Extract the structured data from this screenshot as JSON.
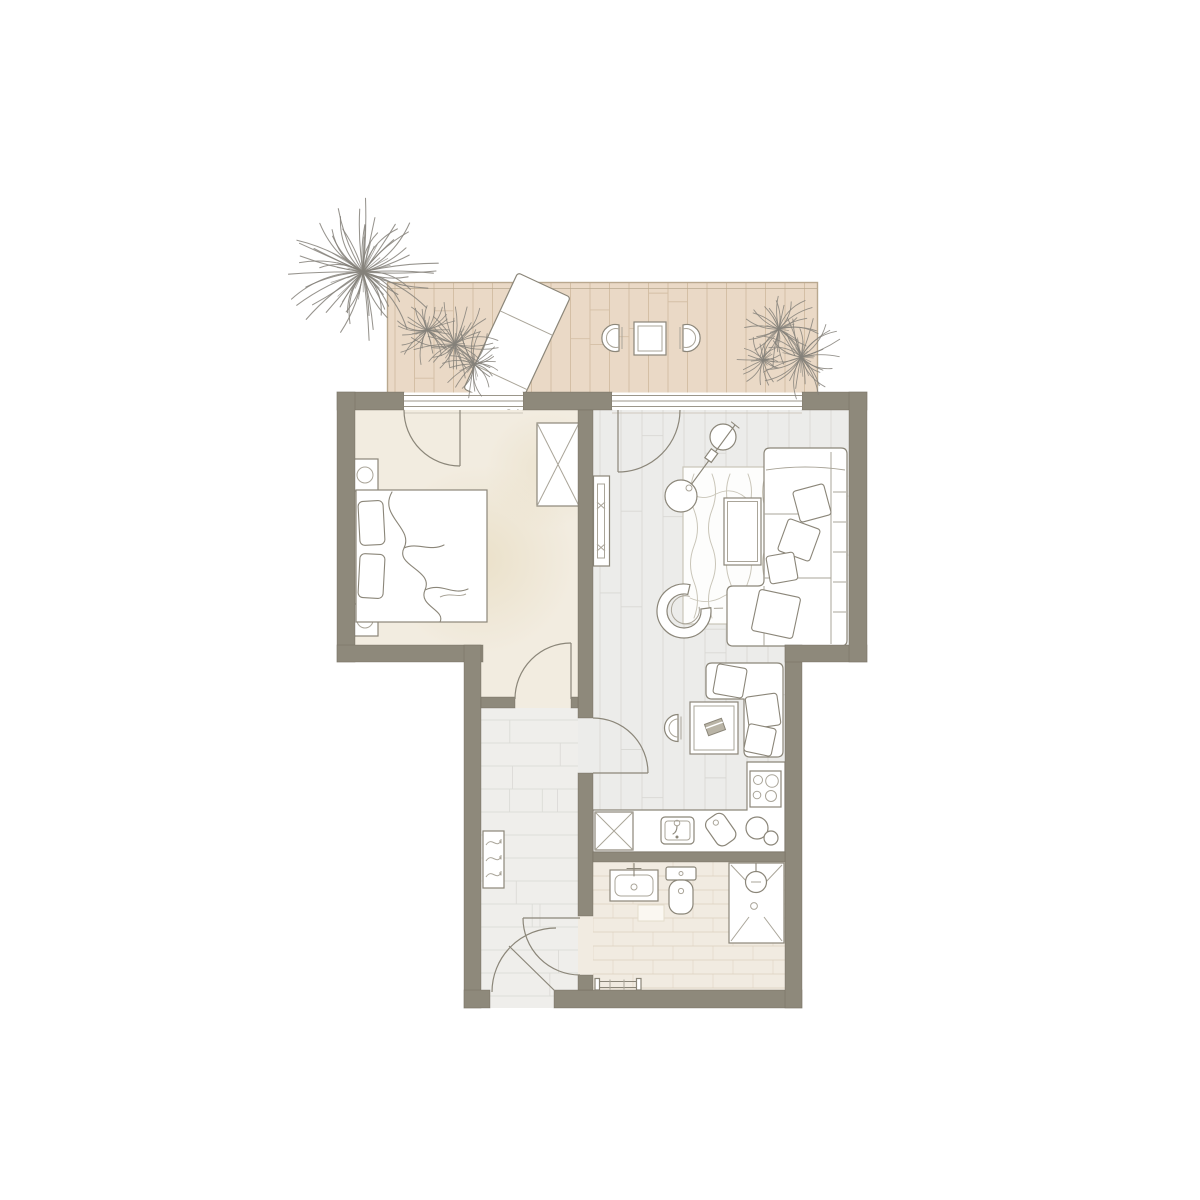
{
  "colors": {
    "wall": "#8e897b",
    "wall-edge": "#6f6a5c",
    "deck": "#ead9c6",
    "deck-line": "#d4bfa5",
    "deck-edge": "#b9a88f",
    "bedroom-floor": "#f2ece0",
    "bedroom-mottle": "#e2d3ae",
    "wood-floor": "#ececea",
    "wood-line": "#d8d7d3",
    "hall-floor": "#efeeeb",
    "hall-line": "#dcdbd7",
    "bath-floor": "#f1ebe1",
    "bath-line": "#ddd2c1",
    "ink": "#8b8679",
    "ink-light": "#aaa599",
    "rug-line": "#c9c5b8",
    "plant": "#85817a",
    "glass": "#9b968a",
    "white": "#ffffff"
  },
  "plan": {
    "rooms": [
      {
        "name": "balcony",
        "furniture": [
          "sun-lounger",
          "bistro-table",
          "cafe-chair",
          "cafe-chair",
          "potted-plant",
          "potted-plant",
          "potted-plant"
        ]
      },
      {
        "name": "bedroom",
        "furniture": [
          "double-bed",
          "pillow",
          "pillow",
          "duvet",
          "nightstand",
          "nightstand",
          "table-lamp",
          "table-lamp",
          "wardrobe"
        ]
      },
      {
        "name": "living-room",
        "furniture": [
          "corner-sofa",
          "cushions",
          "rug",
          "coffee-table",
          "arc-floor-lamp",
          "armchair",
          "tv-sideboard"
        ]
      },
      {
        "name": "dining-nook",
        "furniture": [
          "corner-bench",
          "cushions",
          "dining-table",
          "book",
          "chair"
        ]
      },
      {
        "name": "kitchen",
        "furniture": [
          "counter",
          "base-cabinet",
          "sink",
          "faucet",
          "cutting-board",
          "bowls",
          "cooktop"
        ]
      },
      {
        "name": "bathroom",
        "furniture": [
          "washbasin",
          "toilet",
          "shower",
          "shower-head",
          "towel-radiator",
          "bath-mat"
        ]
      },
      {
        "name": "hallway",
        "furniture": [
          "radiator"
        ]
      }
    ],
    "doors": 6,
    "windows": 2
  }
}
